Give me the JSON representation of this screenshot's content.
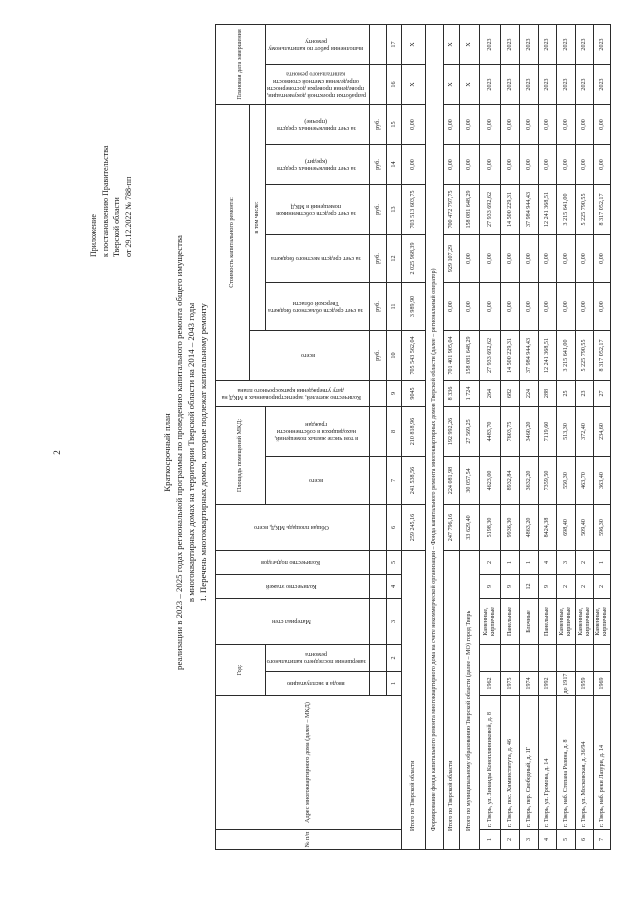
{
  "page_number": "2",
  "appendix_lines": [
    "Приложение",
    "к постановлению Правительства",
    "Тверской области",
    "от 29.12.2022 № 788-пп"
  ],
  "title_lines": [
    "Краткосрочный план",
    "реализации в 2023 – 2025 годах региональной программы по проведению капитального ремонта общего имущества",
    "в многоквартирных домах на территории Тверской области на 2014 – 2043 годы",
    "1. Перечень многоквартирных домов, которые подлежат капитальному ремонту"
  ],
  "table": {
    "header": {
      "num": "№ п/п",
      "address": "Адрес многоквартирного дома (далее – МКД)",
      "year_group": "Год:",
      "year_built": "ввода в эксплуатацию",
      "year_last_repair": "завершения последнего капитального ремонта",
      "wall_material": "Материал стен",
      "floors": "Количество этажей",
      "entrances": "Количество подъездов",
      "total_area": "Общая площадь МКД, всего",
      "premises_area_group": "Площадь помещений МКД:",
      "premises_area_total": "всего",
      "premises_area_citizens": "в том числе жилых помещений, находящихся в собственности граждан",
      "residents": "Количество жителей, зарегистрированных в МКД на дату утверждения краткосрочного плана",
      "cost_group": "Стоимость капитального ремонта:",
      "cost_total": "всего",
      "cost_incl_group": "в том числе:",
      "cost_regional": "за счет средств областного бюджета Тверской области",
      "cost_local": "за счет средств местного бюджета",
      "cost_owners": "за счет средств собственников помещений в МКД",
      "cost_credit": "за счет привлеченных средств (кредит)",
      "cost_other": "за счет привлеченных средств (прочие)",
      "rub_unit": "руб.",
      "date_group": "Плановая дата завершения",
      "date_docs": "разработки проектной документации, проведения проверки достоверности определения сметной стоимости капитального ремонта",
      "date_works": "выполнения работ по капитальному ремонту",
      "col_numbers": [
        "1",
        "2",
        "3",
        "4",
        "5",
        "6",
        "7",
        "8",
        "9",
        "10",
        "11",
        "12",
        "13",
        "14",
        "15",
        "16",
        "17",
        "18",
        "19"
      ]
    },
    "summary_rows": [
      {
        "label": "Итого по Тверской области",
        "merged": false,
        "values": [
          "259 245,16",
          "241 538,56",
          "210 818,96",
          "9045",
          "705 543 562,04",
          "3 989,90",
          "2 025 968,39",
          "703 513 603,75",
          "0,00",
          "0,00",
          "X",
          "X"
        ]
      },
      {
        "label": "Формирование фонда капитального ремонта многоквартирного дома на счете некоммерческой организации – Фонда капитального ремонта многоквартирных домов Тверской области (далее – региональный оператор)",
        "merged": true,
        "values": []
      },
      {
        "label": "Итого по Тверской области",
        "merged": false,
        "values": [
          "247 796,16",
          "224 081,98",
          "192 992,26",
          "8 336",
          "701 401 905,04",
          "0,00",
          "929 107,29",
          "700 472 797,75",
          "0,00",
          "0,00",
          "X",
          "X"
        ]
      },
      {
        "label": "Итого по муниципальному образованию Тверской области (далее – МО) город Тверь",
        "merged": false,
        "values": [
          "33 629,40",
          "30 057,54",
          "27 569,25",
          "1 724",
          "158 081 648,29",
          "0,00",
          "0,00",
          "158 081 648,29",
          "0,00",
          "0,00",
          "X",
          "X"
        ]
      }
    ],
    "rows": [
      [
        "1",
        "г. Тверь, ул. Зинаиды Коноплянниковой, д. 8",
        "1962",
        "",
        "Каменные, кирпичные",
        "9",
        "2",
        "5198,30",
        "4623,00",
        "4483,70",
        "264",
        "27 933 692,62",
        "0,00",
        "0,00",
        "27 933 692,62",
        "0,00",
        "0,00",
        "2023",
        "2023"
      ],
      [
        "2",
        "г. Тверь, пос. Химинститута, д. 46",
        "1975",
        "",
        "Панельные",
        "9",
        "1",
        "9936,30",
        "8932,84",
        "7603,75",
        "682",
        "14 500 229,31",
        "0,00",
        "0,00",
        "14 500 229,31",
        "0,00",
        "0,00",
        "2023",
        "2023"
      ],
      [
        "3",
        "г. Тверь, пер. Свободный, д. 1Г",
        "1974",
        "",
        "Блочные",
        "12",
        "1",
        "4863,20",
        "3632,20",
        "3460,20",
        "224",
        "37 984 944,43",
        "0,00",
        "0,00",
        "37 984 944,43",
        "0,00",
        "0,00",
        "2023",
        "2023"
      ],
      [
        "4",
        "г. Тверь, ул. Громова, д. 14",
        "1992",
        "",
        "Панельные",
        "9",
        "4",
        "8424,38",
        "7359,50",
        "7119,60",
        "288",
        "12 241 368,51",
        "0,00",
        "0,00",
        "12 241 368,51",
        "0,00",
        "0,00",
        "2023",
        "2023"
      ],
      [
        "5",
        "г. Тверь, наб. Степана Разина, д. 8",
        "до 1917",
        "",
        "Каменные, кирпичные",
        "2",
        "3",
        "698,40",
        "550,30",
        "513,30",
        "25",
        "3 215 641,00",
        "0,00",
        "0,00",
        "3 215 641,00",
        "0,00",
        "0,00",
        "2023",
        "2023"
      ],
      [
        "6",
        "г. Тверь, ул. Московская, д. 36/94",
        "1959",
        "",
        "Каменные, кирпичные",
        "2",
        "2",
        "509,40",
        "463,70",
        "372,40",
        "23",
        "5 225 790,55",
        "0,00",
        "0,00",
        "5 225 790,55",
        "0,00",
        "0,00",
        "2023",
        "2023"
      ],
      [
        "7",
        "г. Тверь, наб. реки Лазури, д. 14",
        "1969",
        "",
        "Каменные, кирпичные",
        "2",
        "1",
        "596,30",
        "363,40",
        "234,60",
        "27",
        "8 317 052,17",
        "0,00",
        "0,00",
        "8 317 052,17",
        "0,00",
        "0,00",
        "2023",
        "2023"
      ]
    ]
  }
}
